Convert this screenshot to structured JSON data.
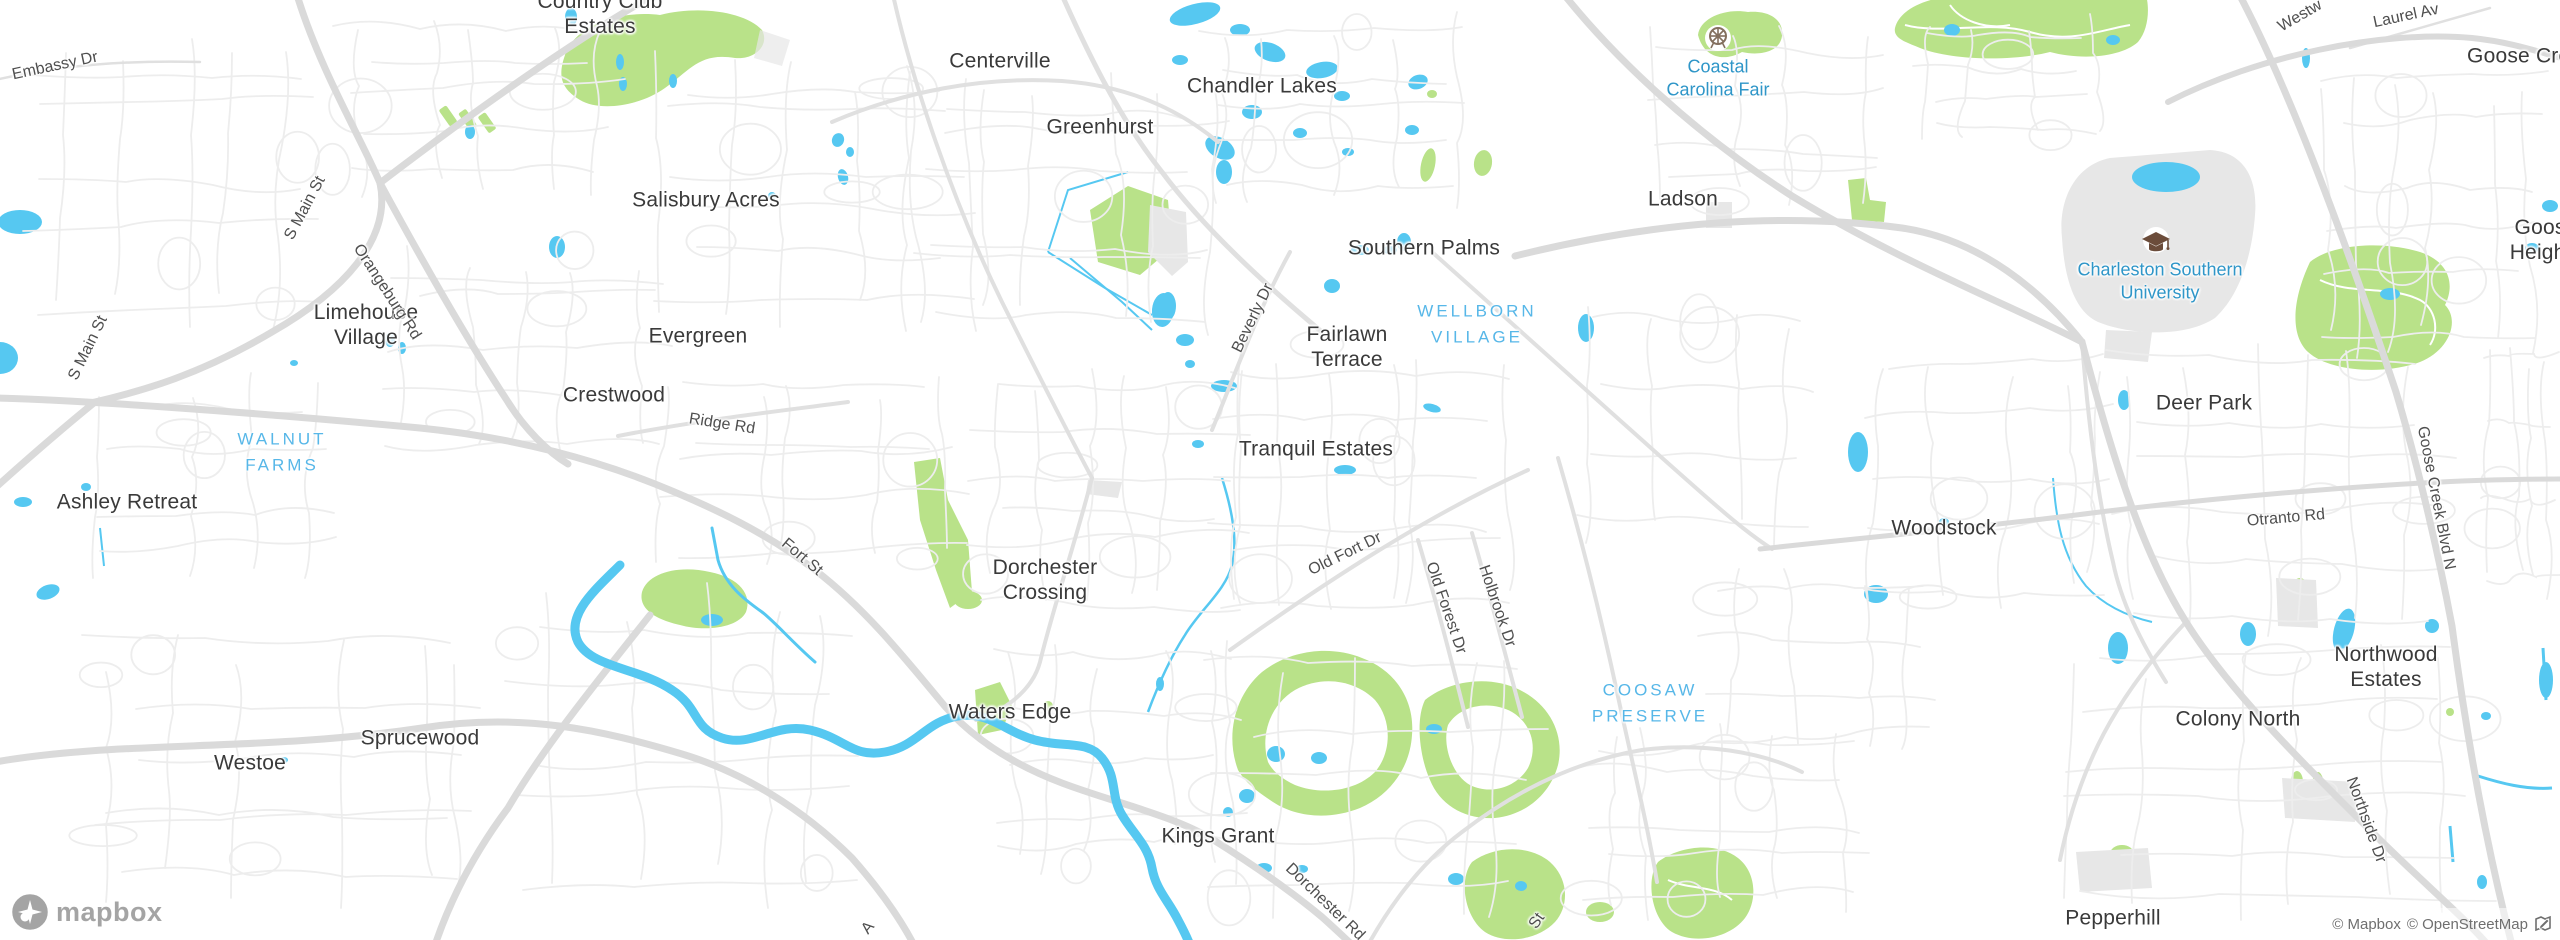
{
  "map": {
    "logo_text": "mapbox",
    "attribution": {
      "text_mapbox": "© Mapbox",
      "text_osm": "© OpenStreetMap"
    }
  },
  "colors": {
    "water": "#56c8f1",
    "park": "#b9e289",
    "road": "#dadada",
    "land": "#ffffff",
    "built": "#e7e7e7",
    "town_label": "#3a3a3a",
    "street_label": "#4f4f4f",
    "area_label": "#57b7e8",
    "poi_label": "#2f96c8",
    "attribution_text": "#6f6f6f"
  },
  "icons": [
    {
      "name": "ferris-wheel-icon",
      "meaning": "amusement park / fairground POI"
    },
    {
      "name": "graduation-cap-icon",
      "meaning": "university POI"
    },
    {
      "name": "mapbox-star-icon",
      "meaning": "mapbox logo mark"
    },
    {
      "name": "improve-map-icon",
      "meaning": "map feedback pencil"
    }
  ],
  "labels": [
    {
      "name": "town-country-club-estates",
      "type": "town",
      "text": "Country Club\nEstates",
      "x": 600,
      "y": 14,
      "rot": 0
    },
    {
      "name": "town-centerville",
      "type": "town",
      "text": "Centerville",
      "x": 1000,
      "y": 61,
      "rot": 0
    },
    {
      "name": "town-greenhurst",
      "type": "town",
      "text": "Greenhurst",
      "x": 1100,
      "y": 127,
      "rot": 0
    },
    {
      "name": "town-chandler-lakes",
      "type": "town",
      "text": "Chandler Lakes",
      "x": 1262,
      "y": 86,
      "rot": 0
    },
    {
      "name": "town-salisbury-acres",
      "type": "town",
      "text": "Salisbury Acres",
      "x": 706,
      "y": 200,
      "rot": 0
    },
    {
      "name": "town-evergreen",
      "type": "town",
      "text": "Evergreen",
      "x": 698,
      "y": 336,
      "rot": 0
    },
    {
      "name": "town-limehouse-village",
      "type": "town",
      "text": "Limehouse\nVillage",
      "x": 366,
      "y": 325,
      "rot": 0
    },
    {
      "name": "town-crestwood",
      "type": "town",
      "text": "Crestwood",
      "x": 614,
      "y": 395,
      "rot": 0
    },
    {
      "name": "town-ashley-retreat",
      "type": "town",
      "text": "Ashley Retreat",
      "x": 127,
      "y": 502,
      "rot": 0
    },
    {
      "name": "town-sprucewood",
      "type": "town",
      "text": "Sprucewood",
      "x": 420,
      "y": 738,
      "rot": 0
    },
    {
      "name": "town-westoe",
      "type": "town",
      "text": "Westoe",
      "x": 250,
      "y": 763,
      "rot": 0
    },
    {
      "name": "town-waters-edge",
      "type": "town",
      "text": "Waters Edge",
      "x": 1010,
      "y": 712,
      "rot": 0
    },
    {
      "name": "town-dorchester-crossing",
      "type": "town",
      "text": "Dorchester\nCrossing",
      "x": 1045,
      "y": 580,
      "rot": 0
    },
    {
      "name": "town-kings-grant",
      "type": "town",
      "text": "Kings Grant",
      "x": 1218,
      "y": 836,
      "rot": 0
    },
    {
      "name": "town-tranquil-estates",
      "type": "town",
      "text": "Tranquil Estates",
      "x": 1316,
      "y": 449,
      "rot": 0
    },
    {
      "name": "town-fairlawn-terrace",
      "type": "town",
      "text": "Fairlawn\nTerrace",
      "x": 1347,
      "y": 347,
      "rot": 0
    },
    {
      "name": "town-southern-palms",
      "type": "town",
      "text": "Southern Palms",
      "x": 1424,
      "y": 248,
      "rot": 0
    },
    {
      "name": "town-ladson",
      "type": "town",
      "text": "Ladson",
      "x": 1683,
      "y": 199,
      "rot": 0
    },
    {
      "name": "town-deer-park",
      "type": "town",
      "text": "Deer Park",
      "x": 2204,
      "y": 403,
      "rot": 0
    },
    {
      "name": "town-woodstock",
      "type": "town",
      "text": "Woodstock",
      "x": 1944,
      "y": 528,
      "rot": 0
    },
    {
      "name": "town-northwood-estates",
      "type": "town",
      "text": "Northwood\nEstates",
      "x": 2386,
      "y": 667,
      "rot": 0
    },
    {
      "name": "town-colony-north",
      "type": "town",
      "text": "Colony North",
      "x": 2238,
      "y": 719,
      "rot": 0
    },
    {
      "name": "town-pepperhill",
      "type": "town",
      "text": "Pepperhill",
      "x": 2113,
      "y": 918,
      "rot": 0
    },
    {
      "name": "town-goose-creek",
      "type": "town",
      "text": "Goose Creek",
      "x": 2530,
      "y": 56,
      "rot": 0
    },
    {
      "name": "town-goose-heights",
      "type": "town",
      "text": "Goose\nHeights",
      "x": 2546,
      "y": 240,
      "rot": 0
    },
    {
      "name": "street-embassy-dr",
      "type": "street",
      "text": "Embassy Dr",
      "x": 55,
      "y": 66,
      "rot": -12
    },
    {
      "name": "street-s-main-st-north",
      "type": "street",
      "text": "S Main St",
      "x": 305,
      "y": 208,
      "rot": -62
    },
    {
      "name": "street-s-main-st-south",
      "type": "street",
      "text": "S Main St",
      "x": 88,
      "y": 348,
      "rot": -64
    },
    {
      "name": "street-orangeburg-rd",
      "type": "street",
      "text": "Orangeburg Rd",
      "x": 387,
      "y": 292,
      "rot": 57
    },
    {
      "name": "street-ridge-rd",
      "type": "street",
      "text": "Ridge Rd",
      "x": 722,
      "y": 424,
      "rot": 9
    },
    {
      "name": "street-fort-st",
      "type": "street",
      "text": "Fort St",
      "x": 802,
      "y": 557,
      "rot": 40
    },
    {
      "name": "street-beverly-dr",
      "type": "street",
      "text": "Beverly Dr",
      "x": 1253,
      "y": 318,
      "rot": -64
    },
    {
      "name": "street-old-fort-dr",
      "type": "street",
      "text": "Old Fort Dr",
      "x": 1345,
      "y": 554,
      "rot": -26
    },
    {
      "name": "street-old-forest-dr",
      "type": "street",
      "text": "Old Forest Dr",
      "x": 1446,
      "y": 608,
      "rot": 71
    },
    {
      "name": "street-holbrook-dr",
      "type": "street",
      "text": "Holbrook Dr",
      "x": 1497,
      "y": 606,
      "rot": 71
    },
    {
      "name": "street-dorchester-rd",
      "type": "street",
      "text": "Dorchester Rd",
      "x": 1325,
      "y": 902,
      "rot": 44
    },
    {
      "name": "street-otranto-rd",
      "type": "street",
      "text": "Otranto Rd",
      "x": 2286,
      "y": 518,
      "rot": -5
    },
    {
      "name": "street-goose-creek-blvd-n",
      "type": "street",
      "text": "Goose Creek Blvd N",
      "x": 2436,
      "y": 498,
      "rot": 79
    },
    {
      "name": "street-northside-dr",
      "type": "street",
      "text": "Northside Dr",
      "x": 2366,
      "y": 820,
      "rot": 70
    },
    {
      "name": "street-laurel-av",
      "type": "street",
      "text": "Laurel Av",
      "x": 2406,
      "y": 16,
      "rot": -12
    },
    {
      "name": "street-westview-partial",
      "type": "street",
      "text": "Westw",
      "x": 2300,
      "y": 16,
      "rot": -30
    },
    {
      "name": "street-st-partial",
      "type": "street",
      "text": "St",
      "x": 1537,
      "y": 921,
      "rot": -55
    },
    {
      "name": "street-a-partial",
      "type": "street",
      "text": "A",
      "x": 868,
      "y": 928,
      "rot": -50
    },
    {
      "name": "area-walnut-farms",
      "type": "area",
      "text": "WALNUT\nFARMS",
      "x": 282,
      "y": 452,
      "rot": 0
    },
    {
      "name": "area-wellborn-village",
      "type": "area",
      "text": "WELLBORN\nVILLAGE",
      "x": 1477,
      "y": 324,
      "rot": 0
    },
    {
      "name": "area-coosaw-preserve",
      "type": "area",
      "text": "COOSAW\nPRESERVE",
      "x": 1650,
      "y": 703,
      "rot": 0
    },
    {
      "name": "poi-coastal-carolina-fair",
      "type": "poi",
      "text": "Coastal\nCarolina Fair",
      "x": 1718,
      "y": 78,
      "rot": 0
    },
    {
      "name": "poi-charleston-southern-university",
      "type": "poi",
      "text": "Charleston Southern\nUniversity",
      "x": 2160,
      "y": 281,
      "rot": 0
    }
  ]
}
